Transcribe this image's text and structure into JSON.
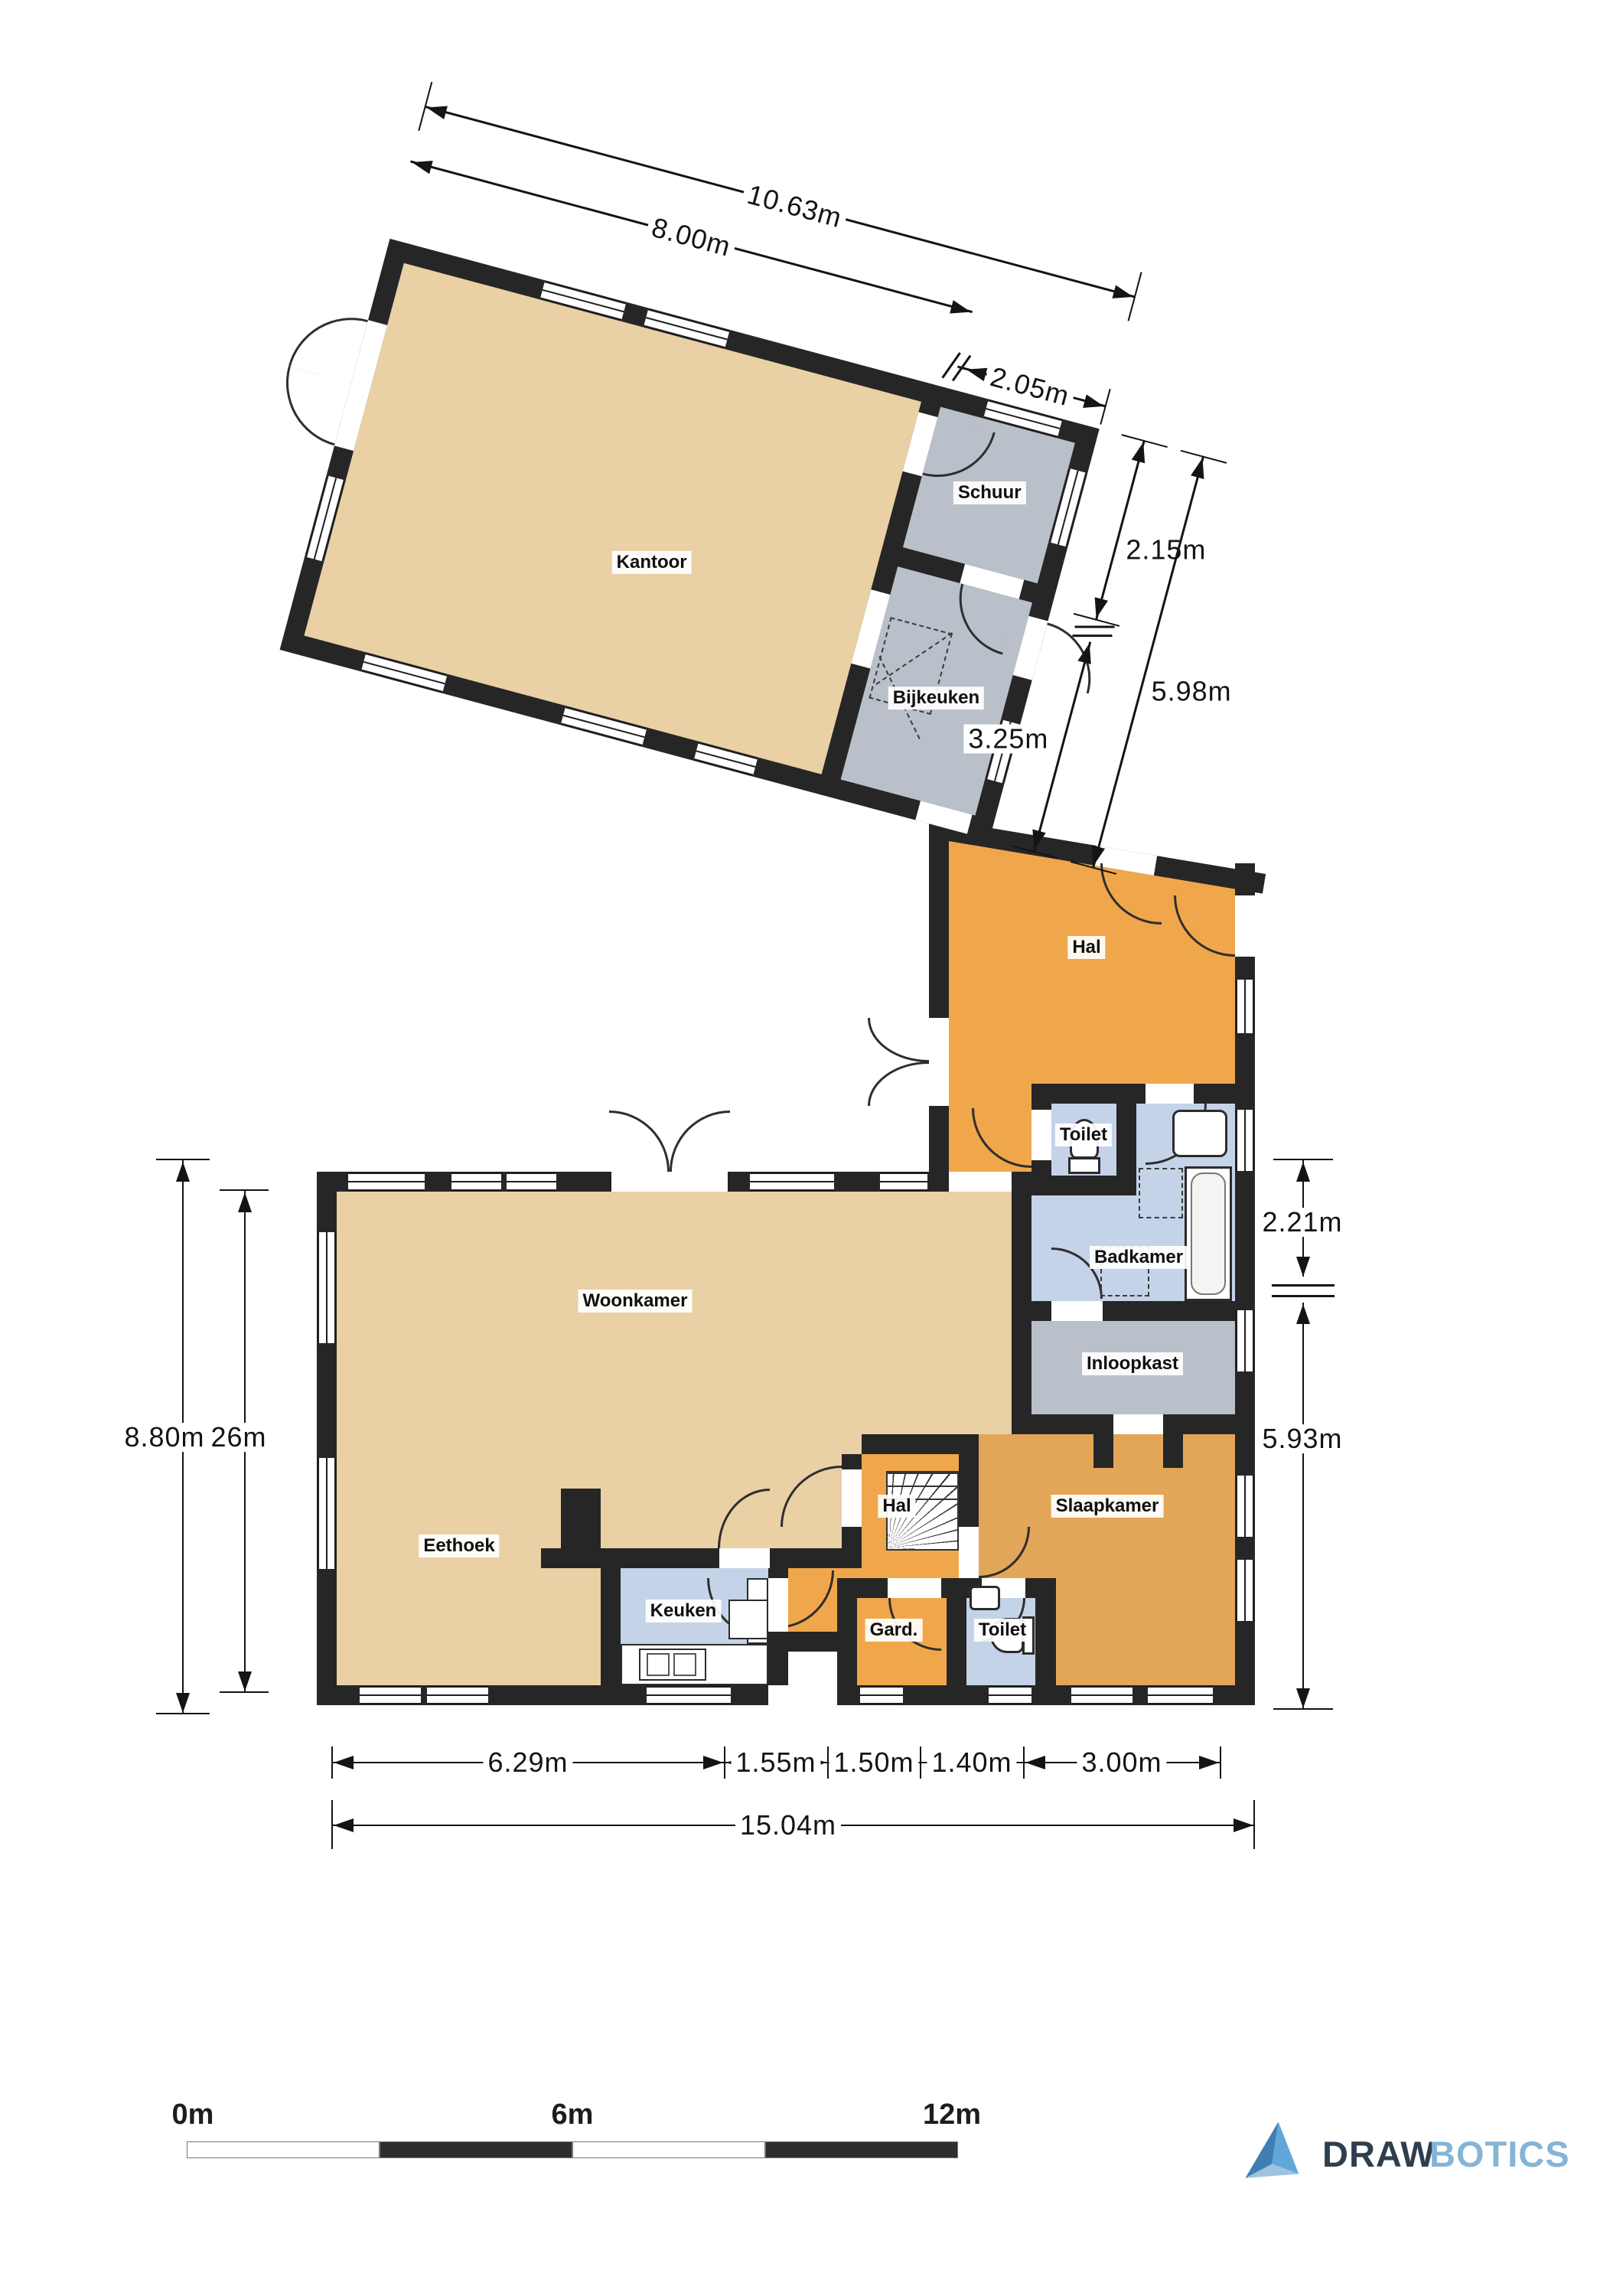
{
  "rooms": {
    "kantoor": "Kantoor",
    "schuur": "Schuur",
    "bijkeuken": "Bijkeuken",
    "hal_boven": "Hal",
    "toilet_boven": "Toilet",
    "badkamer": "Badkamer",
    "woonkamer": "Woonkamer",
    "inloopkast": "Inloopkast",
    "eethoek": "Eethoek",
    "keuken": "Keuken",
    "hal": "Hal",
    "gard": "Gard.",
    "toilet": "Toilet",
    "slaapkamer": "Slaapkamer"
  },
  "dims": {
    "top_total": "10.63m",
    "top_kantoor": "8.00m",
    "top_schuur": "2.05m",
    "right_schuur": "2.15m",
    "right_total": "5.98m",
    "right_bijkeuken": "3.25m",
    "badkamer_height": "2.21m",
    "slaapkamer_height": "5.93m",
    "left_total": "8.80m",
    "left_inner": "26m",
    "bottom_eethoek": "6.29m",
    "bottom_keuken": "1.55m",
    "bottom_hal": "1.50m",
    "bottom_gard": "1.40m",
    "bottom_slaapkamer": "3.00m",
    "bottom_total": "15.04m"
  },
  "scalebar": {
    "zero": "0m",
    "middle": "6m",
    "end": "12m"
  },
  "logo": {
    "word_dark": "DRAW",
    "word_light": "BOTICS"
  },
  "colors": {
    "wall": "#262626",
    "beige": "#e9d0a5",
    "orange": "#f0a74b",
    "bedroom_orange": "#e3a558",
    "blue": "#c4d3e8",
    "gray": "#b9c0ca",
    "dim_line": "#141414",
    "logo_dark": "#2f3e4e",
    "logo_light": "#85b4d6"
  }
}
